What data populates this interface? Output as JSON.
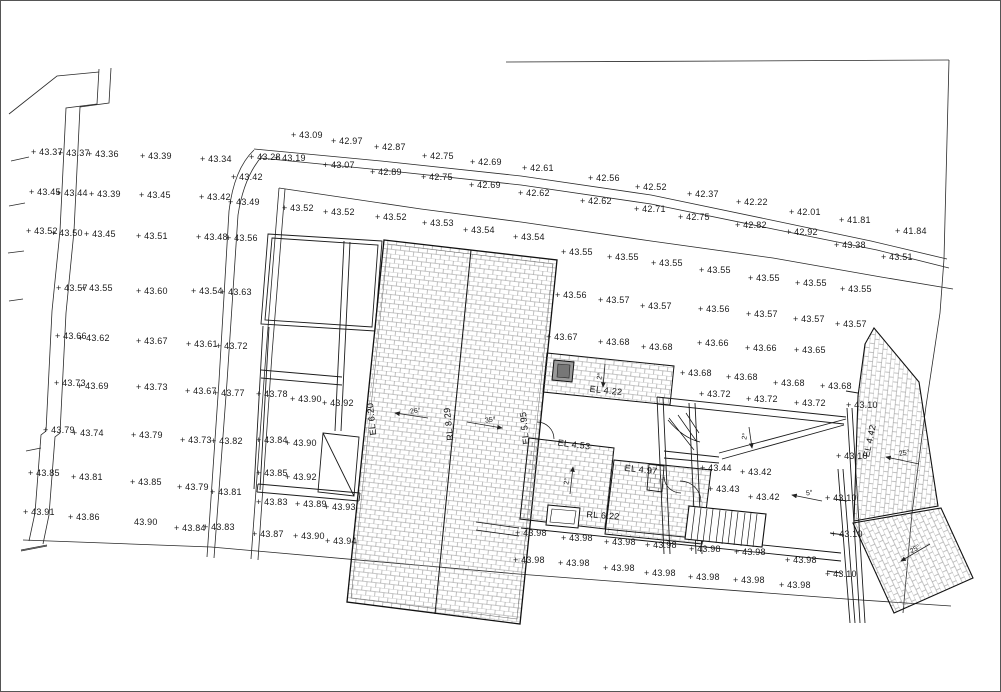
{
  "drawing": {
    "type": "site-survey-roof-plan",
    "line_color": "#2a2a2a",
    "hatch_color": "#8f8f8f",
    "background": "#ffffff"
  },
  "spot_levels": [
    [
      30,
      147,
      "+ 43.37"
    ],
    [
      57,
      148,
      "+ 43.37"
    ],
    [
      86,
      149,
      "+ 43.36"
    ],
    [
      139,
      151,
      "+ 43.39"
    ],
    [
      199,
      154,
      "+ 43.34"
    ],
    [
      248,
      152,
      "+ 43.28"
    ],
    [
      230,
      172,
      "+ 43.42"
    ],
    [
      28,
      187,
      "+ 43.45"
    ],
    [
      55,
      188,
      "+ 43.44"
    ],
    [
      88,
      189,
      "+ 43.39"
    ],
    [
      138,
      190,
      "+ 43.45"
    ],
    [
      198,
      192,
      "+ 43.42"
    ],
    [
      227,
      197,
      "+ 43.49"
    ],
    [
      25,
      226,
      "+ 43.52"
    ],
    [
      50,
      228,
      "+ 43.50"
    ],
    [
      83,
      229,
      "+ 43.45"
    ],
    [
      135,
      231,
      "+ 43.51"
    ],
    [
      195,
      232,
      "+ 43.48"
    ],
    [
      225,
      233,
      "+ 43.56"
    ],
    [
      55,
      283,
      "+ 43.57"
    ],
    [
      80,
      283,
      "+ 43.55"
    ],
    [
      135,
      286,
      "+ 43.60"
    ],
    [
      190,
      286,
      "+ 43.54"
    ],
    [
      219,
      287,
      "+ 43.63"
    ],
    [
      54,
      331,
      "+ 43.66"
    ],
    [
      77,
      333,
      "+ 43.62"
    ],
    [
      135,
      336,
      "+ 43.67"
    ],
    [
      185,
      339,
      "+ 43.61"
    ],
    [
      215,
      341,
      "+ 43.72"
    ],
    [
      53,
      378,
      "+ 43.73"
    ],
    [
      76,
      381,
      "+ 43.69"
    ],
    [
      135,
      382,
      "+ 43.73"
    ],
    [
      184,
      386,
      "+ 43.67"
    ],
    [
      212,
      388,
      "+ 43.77"
    ],
    [
      42,
      425,
      "+ 43.79"
    ],
    [
      71,
      428,
      "+ 43.74"
    ],
    [
      130,
      430,
      "+ 43.79"
    ],
    [
      179,
      435,
      "+ 43.73"
    ],
    [
      210,
      436,
      "+ 43.82"
    ],
    [
      27,
      468,
      "+ 43.85"
    ],
    [
      70,
      472,
      "+ 43.81"
    ],
    [
      129,
      477,
      "+ 43.85"
    ],
    [
      176,
      482,
      "+ 43.79"
    ],
    [
      209,
      487,
      "+ 43.81"
    ],
    [
      22,
      507,
      "+ 43.91"
    ],
    [
      67,
      512,
      "+ 43.86"
    ],
    [
      133,
      517,
      "43.90"
    ],
    [
      173,
      523,
      "+ 43.84"
    ],
    [
      202,
      522,
      "+ 43.83"
    ],
    [
      290,
      130,
      "+ 43.09"
    ],
    [
      330,
      136,
      "+ 42.97"
    ],
    [
      373,
      142,
      "+ 42.87"
    ],
    [
      421,
      151,
      "+ 42.75"
    ],
    [
      469,
      157,
      "+ 42.69"
    ],
    [
      521,
      163,
      "+ 42.61"
    ],
    [
      587,
      173,
      "+ 42.56"
    ],
    [
      634,
      182,
      "+ 42.52"
    ],
    [
      686,
      189,
      "+ 42.37"
    ],
    [
      735,
      197,
      "+ 42.22"
    ],
    [
      788,
      207,
      "+ 42.01"
    ],
    [
      838,
      215,
      "+ 41.81"
    ],
    [
      894,
      226,
      "+ 41.84"
    ],
    [
      273,
      153,
      "+ 43.19"
    ],
    [
      322,
      160,
      "+ 43.07"
    ],
    [
      369,
      167,
      "+ 42.89"
    ],
    [
      420,
      172,
      "+ 42.75"
    ],
    [
      468,
      180,
      "+ 42.69"
    ],
    [
      517,
      188,
      "+ 42.62"
    ],
    [
      579,
      196,
      "+ 42.62"
    ],
    [
      633,
      204,
      "+ 42.71"
    ],
    [
      677,
      212,
      "+ 42.75"
    ],
    [
      734,
      220,
      "+ 42.82"
    ],
    [
      785,
      227,
      "+ 42.92"
    ],
    [
      833,
      240,
      "+ 43.38"
    ],
    [
      880,
      252,
      "+ 43.51"
    ],
    [
      281,
      203,
      "+ 43.52"
    ],
    [
      322,
      207,
      "+ 43.52"
    ],
    [
      374,
      212,
      "+ 43.52"
    ],
    [
      421,
      218,
      "+ 43.53"
    ],
    [
      462,
      225,
      "+ 43.54"
    ],
    [
      512,
      232,
      "+ 43.54"
    ],
    [
      560,
      247,
      "+ 43.55"
    ],
    [
      606,
      252,
      "+ 43.55"
    ],
    [
      650,
      258,
      "+ 43.55"
    ],
    [
      698,
      265,
      "+ 43.55"
    ],
    [
      747,
      273,
      "+ 43.55"
    ],
    [
      794,
      278,
      "+ 43.55"
    ],
    [
      839,
      284,
      "+ 43.55"
    ],
    [
      554,
      290,
      "+ 43.56"
    ],
    [
      597,
      295,
      "+ 43.57"
    ],
    [
      639,
      301,
      "+ 43.57"
    ],
    [
      697,
      304,
      "+ 43.56"
    ],
    [
      745,
      309,
      "+ 43.57"
    ],
    [
      792,
      314,
      "+ 43.57"
    ],
    [
      834,
      319,
      "+ 43.57"
    ],
    [
      545,
      332,
      "+ 43.67"
    ],
    [
      597,
      337,
      "+ 43.68"
    ],
    [
      640,
      342,
      "+ 43.68"
    ],
    [
      696,
      338,
      "+ 43.66"
    ],
    [
      744,
      343,
      "+ 43.66"
    ],
    [
      793,
      345,
      "+ 43.65"
    ],
    [
      679,
      368,
      "+ 43.68"
    ],
    [
      725,
      372,
      "+ 43.68"
    ],
    [
      772,
      378,
      "+ 43.68"
    ],
    [
      819,
      381,
      "+ 43.68"
    ],
    [
      698,
      389,
      "+ 43.72"
    ],
    [
      745,
      394,
      "+ 43.72"
    ],
    [
      793,
      398,
      "+ 43.72"
    ],
    [
      255,
      389,
      "+ 43.78"
    ],
    [
      289,
      394,
      "+ 43.90"
    ],
    [
      321,
      398,
      "+ 43.92"
    ],
    [
      255,
      435,
      "+ 43.84"
    ],
    [
      284,
      438,
      "+ 43.90"
    ],
    [
      255,
      468,
      "+ 43.85"
    ],
    [
      284,
      472,
      "+ 43.92"
    ],
    [
      255,
      497,
      "+ 43.83"
    ],
    [
      294,
      499,
      "+ 43.89"
    ],
    [
      323,
      502,
      "+ 43.93"
    ],
    [
      251,
      529,
      "+ 43.87"
    ],
    [
      292,
      531,
      "+ 43.90"
    ],
    [
      324,
      536,
      "+ 43.94"
    ],
    [
      699,
      463,
      "+ 43.44"
    ],
    [
      739,
      467,
      "+ 43.42"
    ],
    [
      707,
      484,
      "+ 43.43"
    ],
    [
      747,
      492,
      "+ 43.42"
    ],
    [
      845,
      400,
      "+ 43.10"
    ],
    [
      835,
      451,
      "+ 43.10"
    ],
    [
      824,
      493,
      "+ 43.10"
    ],
    [
      830,
      529,
      "+ 43.10"
    ],
    [
      824,
      569,
      "+ 43.10"
    ],
    [
      514,
      528,
      "+ 43.98"
    ],
    [
      560,
      533,
      "+ 43.98"
    ],
    [
      603,
      537,
      "+ 43.98"
    ],
    [
      644,
      540,
      "+ 43.98"
    ],
    [
      688,
      544,
      "+ 43.98"
    ],
    [
      733,
      547,
      "+ 43.98"
    ],
    [
      784,
      555,
      "+ 43.98"
    ],
    [
      512,
      555,
      "+ 43.98"
    ],
    [
      557,
      558,
      "+ 43.98"
    ],
    [
      602,
      563,
      "+ 43.98"
    ],
    [
      643,
      568,
      "+ 43.98"
    ],
    [
      687,
      572,
      "+ 43.98"
    ],
    [
      732,
      575,
      "+ 43.98"
    ],
    [
      778,
      580,
      "+ 43.98"
    ]
  ],
  "level_labels": [
    {
      "x": 371,
      "y": 418,
      "t": "EL 6.20",
      "r": -96
    },
    {
      "x": 448,
      "y": 423,
      "t": "RL 8.29",
      "r": -96
    },
    {
      "x": 524,
      "y": 427,
      "t": "EL 5.95",
      "r": -96
    },
    {
      "x": 869,
      "y": 440,
      "t": "EL 4.42",
      "r": -78
    },
    {
      "x": 605,
      "y": 390,
      "t": "EL 4.22",
      "r": 6
    },
    {
      "x": 573,
      "y": 444,
      "t": "EL 4.53",
      "r": 7
    },
    {
      "x": 640,
      "y": 469,
      "t": "EL 4.97",
      "r": 6
    },
    {
      "x": 602,
      "y": 515,
      "t": "RL 6.22",
      "r": 4
    }
  ],
  "slope_arrows": [
    {
      "x1": 427,
      "y1": 417,
      "x2": 394,
      "y2": 412,
      "t": "26°",
      "lx": 409,
      "ly": 407,
      "lr": -7
    },
    {
      "x1": 466,
      "y1": 421,
      "x2": 501,
      "y2": 427,
      "t": "35°",
      "lx": 484,
      "ly": 416,
      "lr": -7
    },
    {
      "x1": 604,
      "y1": 363,
      "x2": 602,
      "y2": 386,
      "t": "2°",
      "lx": 596,
      "ly": 372,
      "lr": -80
    },
    {
      "x1": 569,
      "y1": 493,
      "x2": 572,
      "y2": 466,
      "t": "2°",
      "lx": 563,
      "ly": 477,
      "lr": -80
    },
    {
      "x1": 748,
      "y1": 426,
      "x2": 751,
      "y2": 447,
      "t": "2°",
      "lx": 741,
      "ly": 432,
      "lr": -80
    },
    {
      "x1": 821,
      "y1": 500,
      "x2": 791,
      "y2": 494,
      "t": "5°",
      "lx": 805,
      "ly": 489,
      "lr": -8
    },
    {
      "x1": 918,
      "y1": 463,
      "x2": 885,
      "y2": 456,
      "t": "25°",
      "lx": 898,
      "ly": 449,
      "lr": -10
    },
    {
      "x1": 929,
      "y1": 543,
      "x2": 900,
      "y2": 560,
      "t": "25°",
      "lx": 909,
      "ly": 545,
      "lr": -30
    }
  ]
}
